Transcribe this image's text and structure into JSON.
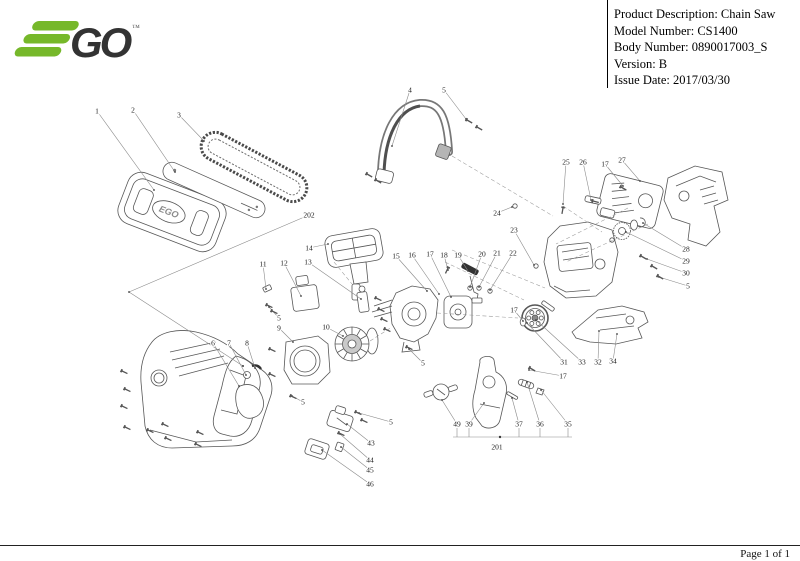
{
  "header": {
    "logo": {
      "brand": "EGO",
      "trademark": "™",
      "green": "#76b82a",
      "dark": "#333333"
    },
    "info_rows": [
      "Product Description: Chain Saw",
      "Model Number: CS1400",
      "Body Number: 0890017003_S",
      "Version: B",
      "Issue Date: 2017/03/30"
    ]
  },
  "footer": {
    "page_label": "Page 1 of 1"
  },
  "diagram": {
    "description": "Exploded parts diagram of EGO CS1400 chain saw",
    "cover_logo_text": "EGO",
    "callouts": [
      {
        "n": "1",
        "x": 97,
        "y": 111,
        "tx": 154,
        "ty": 190
      },
      {
        "n": "2",
        "x": 133,
        "y": 110,
        "tx": 175,
        "ty": 172
      },
      {
        "n": "3",
        "x": 179,
        "y": 115,
        "tx": 204,
        "ty": 141
      },
      {
        "n": "4",
        "x": 410,
        "y": 90,
        "tx": 392,
        "ty": 146
      },
      {
        "n": "5",
        "x": 444,
        "y": 90,
        "tx": 466,
        "ty": 119
      },
      {
        "n": "202",
        "x": 309,
        "y": 215,
        "tx": 129,
        "ty": 292
      },
      {
        "n": "14",
        "x": 309,
        "y": 248,
        "tx": 328,
        "ty": 244
      },
      {
        "n": "11",
        "x": 263,
        "y": 264,
        "tx": 266,
        "ty": 289
      },
      {
        "n": "12",
        "x": 284,
        "y": 263,
        "tx": 301,
        "ty": 296
      },
      {
        "n": "13",
        "x": 308,
        "y": 262,
        "tx": 361,
        "ty": 299
      },
      {
        "n": "15",
        "x": 396,
        "y": 256,
        "tx": 427,
        "ty": 291
      },
      {
        "n": "16",
        "x": 412,
        "y": 255,
        "tx": 439,
        "ty": 294
      },
      {
        "n": "17",
        "x": 430,
        "y": 254,
        "tx": 451,
        "ty": 297
      },
      {
        "n": "18",
        "x": 444,
        "y": 255,
        "tx": 448,
        "ty": 270
      },
      {
        "n": "19",
        "x": 458,
        "y": 255,
        "tx": 468,
        "ty": 271
      },
      {
        "n": "20",
        "x": 482,
        "y": 254,
        "tx": 470,
        "ty": 287
      },
      {
        "n": "21",
        "x": 497,
        "y": 253,
        "tx": 479,
        "ty": 287
      },
      {
        "n": "22",
        "x": 513,
        "y": 253,
        "tx": 490,
        "ty": 290
      },
      {
        "n": "24",
        "x": 497,
        "y": 213,
        "tx": 512,
        "ty": 207
      },
      {
        "n": "23",
        "x": 514,
        "y": 230,
        "tx": 534,
        "ty": 265
      },
      {
        "n": "25",
        "x": 566,
        "y": 162,
        "tx": 563,
        "ty": 204
      },
      {
        "n": "26",
        "x": 583,
        "y": 162,
        "tx": 591,
        "ty": 200
      },
      {
        "n": "17",
        "x": 605,
        "y": 164,
        "tx": 623,
        "ty": 186
      },
      {
        "n": "27",
        "x": 622,
        "y": 160,
        "tx": 640,
        "ty": 181
      },
      {
        "n": "28",
        "x": 686,
        "y": 249,
        "tx": 643,
        "ty": 223
      },
      {
        "n": "29",
        "x": 686,
        "y": 261,
        "tx": 626,
        "ty": 232
      },
      {
        "n": "30",
        "x": 686,
        "y": 273,
        "tx": 647,
        "ty": 259
      },
      {
        "n": "5",
        "x": 688,
        "y": 286,
        "tx": 659,
        "ty": 277
      },
      {
        "n": "17",
        "x": 514,
        "y": 310,
        "tx": 523,
        "ty": 321
      },
      {
        "n": "5",
        "x": 279,
        "y": 318,
        "tx": 269,
        "ty": 307
      },
      {
        "n": "9",
        "x": 279,
        "y": 328,
        "tx": 293,
        "ty": 342
      },
      {
        "n": "10",
        "x": 326,
        "y": 327,
        "tx": 343,
        "ty": 336
      },
      {
        "n": "6",
        "x": 213,
        "y": 343,
        "tx": 239,
        "ty": 386
      },
      {
        "n": "7",
        "x": 229,
        "y": 343,
        "tx": 246,
        "ty": 375
      },
      {
        "n": "8",
        "x": 247,
        "y": 343,
        "tx": 255,
        "ty": 368
      },
      {
        "n": "5",
        "x": 423,
        "y": 363,
        "tx": 409,
        "ty": 349
      },
      {
        "n": "31",
        "x": 564,
        "y": 362,
        "tx": 527,
        "ty": 323
      },
      {
        "n": "33",
        "x": 582,
        "y": 362,
        "tx": 536,
        "ty": 320
      },
      {
        "n": "32",
        "x": 598,
        "y": 362,
        "tx": 599,
        "ty": 331
      },
      {
        "n": "34",
        "x": 613,
        "y": 361,
        "tx": 617,
        "ty": 334
      },
      {
        "n": "17",
        "x": 563,
        "y": 376,
        "tx": 529,
        "ty": 370
      },
      {
        "n": "5",
        "x": 303,
        "y": 402,
        "tx": 292,
        "ty": 396
      },
      {
        "n": "5",
        "x": 391,
        "y": 422,
        "tx": 359,
        "ty": 413
      },
      {
        "n": "43",
        "x": 371,
        "y": 443,
        "tx": 347,
        "ty": 424
      },
      {
        "n": "44",
        "x": 370,
        "y": 460,
        "tx": 340,
        "ty": 434
      },
      {
        "n": "45",
        "x": 370,
        "y": 470,
        "tx": 341,
        "ty": 447
      },
      {
        "n": "46",
        "x": 370,
        "y": 484,
        "tx": 322,
        "ty": 450
      },
      {
        "n": "49",
        "x": 457,
        "y": 424,
        "tx": 442,
        "ty": 400
      },
      {
        "n": "39",
        "x": 469,
        "y": 424,
        "tx": 484,
        "ty": 403
      },
      {
        "n": "37",
        "x": 519,
        "y": 424,
        "tx": 512,
        "ty": 398
      },
      {
        "n": "36",
        "x": 540,
        "y": 424,
        "tx": 527,
        "ty": 382
      },
      {
        "n": "35",
        "x": 568,
        "y": 424,
        "tx": 541,
        "ty": 390
      },
      {
        "n": "201",
        "x": 497,
        "y": 447
      }
    ],
    "screws": [
      [
        467,
        120,
        30
      ],
      [
        477,
        127,
        30
      ],
      [
        367,
        174,
        30
      ],
      [
        376,
        180,
        30
      ],
      [
        122,
        371,
        25
      ],
      [
        125,
        389,
        25
      ],
      [
        122,
        406,
        25
      ],
      [
        125,
        427,
        25
      ],
      [
        148,
        430,
        25
      ],
      [
        163,
        424,
        25
      ],
      [
        166,
        438,
        25
      ],
      [
        198,
        432,
        25
      ],
      [
        196,
        444,
        25
      ],
      [
        267,
        305,
        25
      ],
      [
        272,
        311,
        25
      ],
      [
        270,
        349,
        25
      ],
      [
        270,
        374,
        25
      ],
      [
        376,
        298,
        25
      ],
      [
        379,
        309,
        25
      ],
      [
        382,
        319,
        25
      ],
      [
        385,
        329,
        25
      ],
      [
        407,
        347,
        25
      ],
      [
        448,
        268,
        115
      ],
      [
        563,
        208,
        100
      ],
      [
        621,
        187,
        30
      ],
      [
        593,
        201,
        15
      ],
      [
        641,
        256,
        30
      ],
      [
        652,
        266,
        30
      ],
      [
        658,
        276,
        30
      ],
      [
        356,
        412,
        25
      ],
      [
        362,
        420,
        25
      ],
      [
        291,
        396,
        25
      ],
      [
        339,
        433,
        25
      ],
      [
        530,
        368,
        30
      ]
    ],
    "rings": [
      [
        470,
        288
      ],
      [
        479,
        288
      ],
      [
        490,
        291
      ],
      [
        515,
        206
      ],
      [
        536,
        266
      ],
      [
        612,
        240
      ]
    ],
    "dashed_lines": [
      [
        452,
        156,
        553,
        216
      ],
      [
        563,
        206,
        602,
        232
      ],
      [
        628,
        208,
        556,
        244
      ],
      [
        648,
        224,
        566,
        262
      ],
      [
        445,
        262,
        524,
        300
      ],
      [
        452,
        250,
        545,
        288
      ],
      [
        370,
        341,
        392,
        327
      ],
      [
        437,
        313,
        518,
        318
      ],
      [
        334,
        262,
        352,
        284
      ]
    ],
    "extra_lines": [
      [
        129,
        292,
        243,
        366
      ]
    ],
    "extra_dots": [
      [
        243,
        366
      ]
    ],
    "group_bracket": {
      "label_for": "201",
      "y": 437,
      "x1": 453,
      "x2": 572,
      "tick_top": 428,
      "ticks": [
        457,
        469,
        519,
        540,
        568
      ],
      "dot_x": 500
    }
  }
}
